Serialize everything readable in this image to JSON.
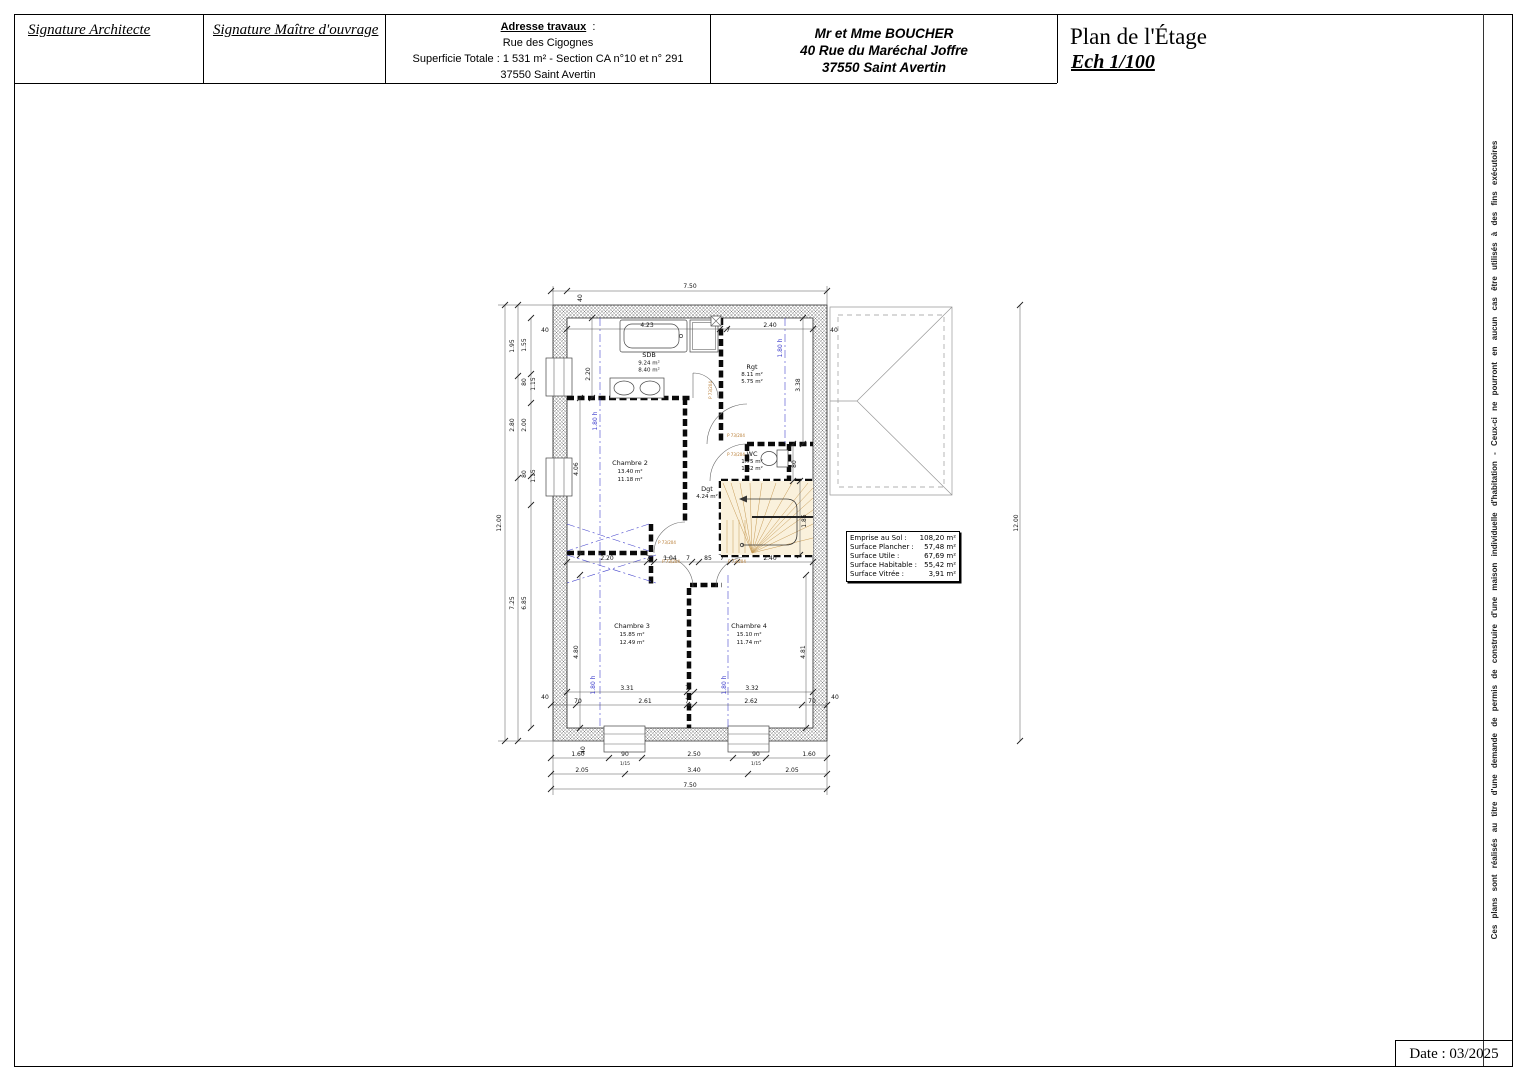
{
  "title_block": {
    "signature_architect": "Signature Architecte",
    "signature_owner": "Signature Maître d'ouvrage",
    "address_heading": "Adresse travaux",
    "address_colon": ":",
    "address_line1": "Rue des Cigognes",
    "address_line2": "Superficie Totale : 1 531 m² - Section CA n°10 et n° 291",
    "address_line3": "37550 Saint Avertin",
    "client_line1": "Mr et Mme BOUCHER",
    "client_line2": "40 Rue du Maréchal Joffre",
    "client_line3": "37550 Saint Avertin",
    "plan_title": "Plan de l'Étage",
    "scale_label": "Ech 1/100"
  },
  "side_note": "Ces plans sont réalisés au titre d'une demande de permis de construire d'une maison individuelle d'habitation - Ceux-ci ne pourront en aucun cas être utilisés à des fins exécutoires",
  "date_label": "Date : 03/2025",
  "door_tag": "P 73/204",
  "rooms": [
    {
      "name": "SDB",
      "area1": "9.24 m²",
      "area2": "8.40 m²"
    },
    {
      "name": "Rgt",
      "area1": "8.11 m²",
      "area2": "5.75 m²"
    },
    {
      "name": "Chambre 2",
      "area1": "13.40 m²",
      "area2": "11.18 m²"
    },
    {
      "name": "WC",
      "area1": "1.75 m²",
      "area2": "1.62 m²"
    },
    {
      "name": "Dgt",
      "area1": "4.24 m²",
      "area2": ""
    },
    {
      "name": "Chambre 3",
      "area1": "15.85 m²",
      "area2": "12.49 m²"
    },
    {
      "name": "Chambre 4",
      "area1": "15.10 m²",
      "area2": "11.74 m²"
    }
  ],
  "surface_table": {
    "colon": ":",
    "rows": [
      {
        "label": "Emprise au Sol",
        "value": "108,20 m²"
      },
      {
        "label": "Surface Plancher",
        "value": "57,48 m²"
      },
      {
        "label": "Surface Utile",
        "value": "67,69 m²"
      },
      {
        "label": "Surface Habitable",
        "value": "55,42 m²"
      },
      {
        "label": "Surface Vitrée",
        "value": "3,91 m²"
      }
    ]
  },
  "dims": [
    "7.50",
    "40",
    "40",
    "4.23",
    "7",
    "2.40",
    "40",
    "1.80 h",
    "3.38",
    "12.00",
    "1.95",
    "2.80",
    "7.25",
    "1.55",
    "80",
    "1.15",
    "2.00",
    "80",
    "1.15",
    "6.85",
    "2.20",
    "1.80 h",
    "4.06",
    "2.20",
    "7",
    "1.04",
    "7",
    "85",
    "7",
    "2.40",
    "1.85",
    "80",
    "4.80",
    "4.81",
    "1.80 h",
    "1.80 h",
    "3.31",
    "7",
    "3.32",
    "40",
    "40",
    "70",
    "2.61",
    "7",
    "2.62",
    "70",
    "40",
    "1.60",
    "90",
    "2.50",
    "90",
    "1.60",
    "1/15",
    "1/15",
    "2.05",
    "3.40",
    "2.05",
    "7.50",
    "12.00"
  ],
  "colors": {
    "dim_blue": "#3a3acc",
    "door_orange": "#b5782d",
    "stair_fill": "#faf1dc",
    "stair_line": "#c59a55"
  }
}
